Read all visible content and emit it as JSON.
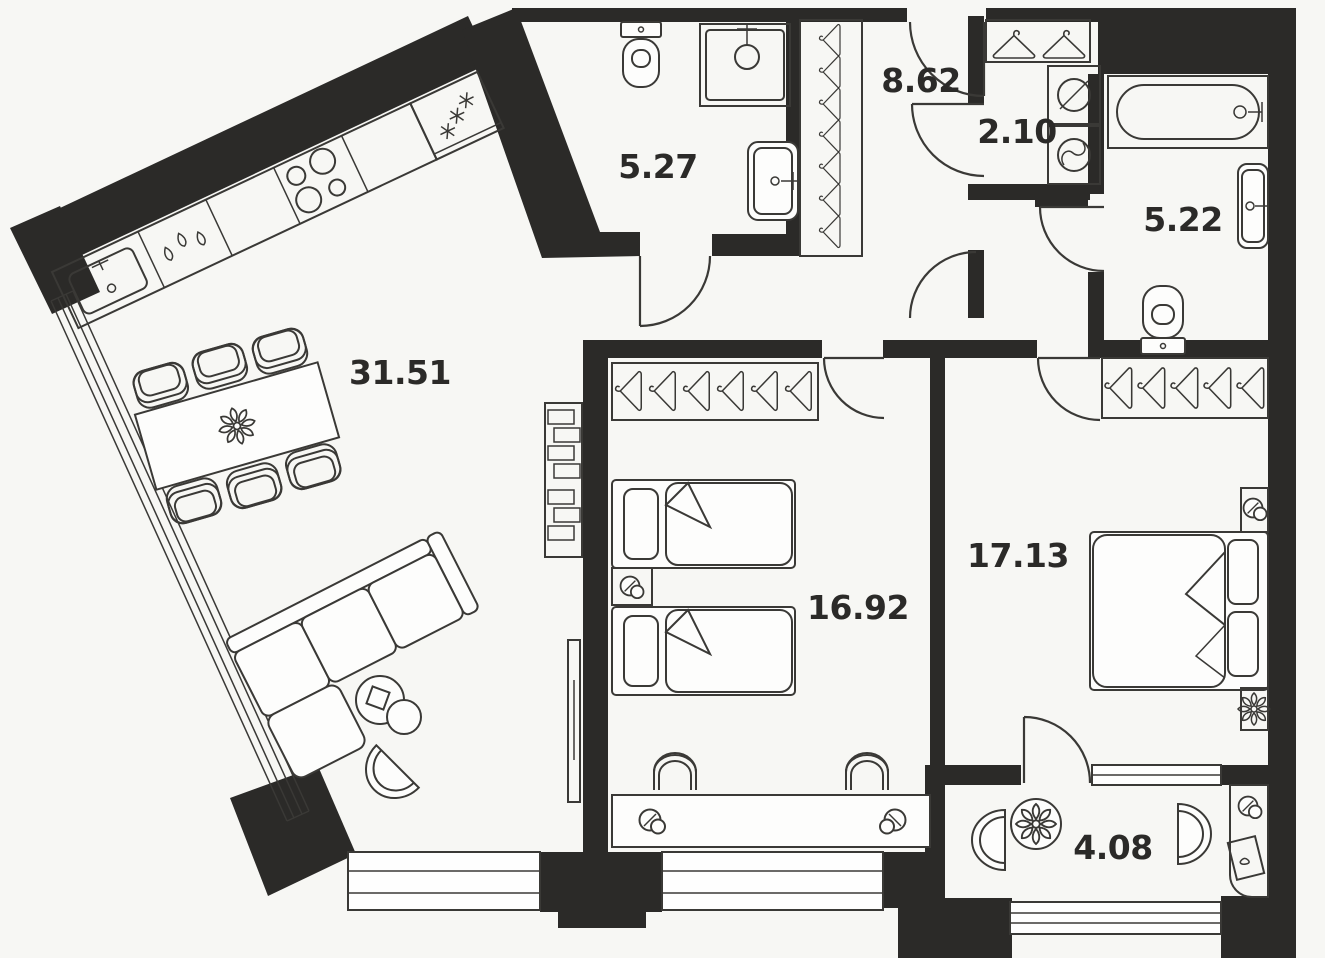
{
  "plan": {
    "background_color": "#f7f7f4",
    "wall_color": "#2b2a28",
    "line_color": "#3a3936",
    "furniture_fill": "#fdfdfc",
    "text_color": "#2b2a28",
    "rooms": [
      {
        "name": "living-room-kitchen",
        "area_label": "31.51"
      },
      {
        "name": "bathroom-small",
        "area_label": "5.27"
      },
      {
        "name": "hallway",
        "area_label": "8.62"
      },
      {
        "name": "laundry-closet",
        "area_label": "2.10"
      },
      {
        "name": "bathroom-main",
        "area_label": "5.22"
      },
      {
        "name": "bedroom-children",
        "area_label": "16.92"
      },
      {
        "name": "bedroom-master",
        "area_label": "17.13"
      },
      {
        "name": "balcony",
        "area_label": "4.08"
      }
    ],
    "fixtures": [
      "kitchen-sink",
      "dishwasher",
      "cooktop",
      "fridge",
      "dining-table",
      "dining-chair",
      "sofa",
      "coffee-table",
      "armchair",
      "shelf-unit",
      "tv-panel",
      "toilet",
      "shower",
      "washbasin",
      "bathtub",
      "washing-machine",
      "tumble-dryer",
      "clothes-hanger",
      "single-bed",
      "double-bed",
      "nightstand",
      "table-lamp",
      "desk",
      "desk-chair",
      "plant",
      "side-table",
      "balcony-round-table",
      "window",
      "door"
    ]
  }
}
